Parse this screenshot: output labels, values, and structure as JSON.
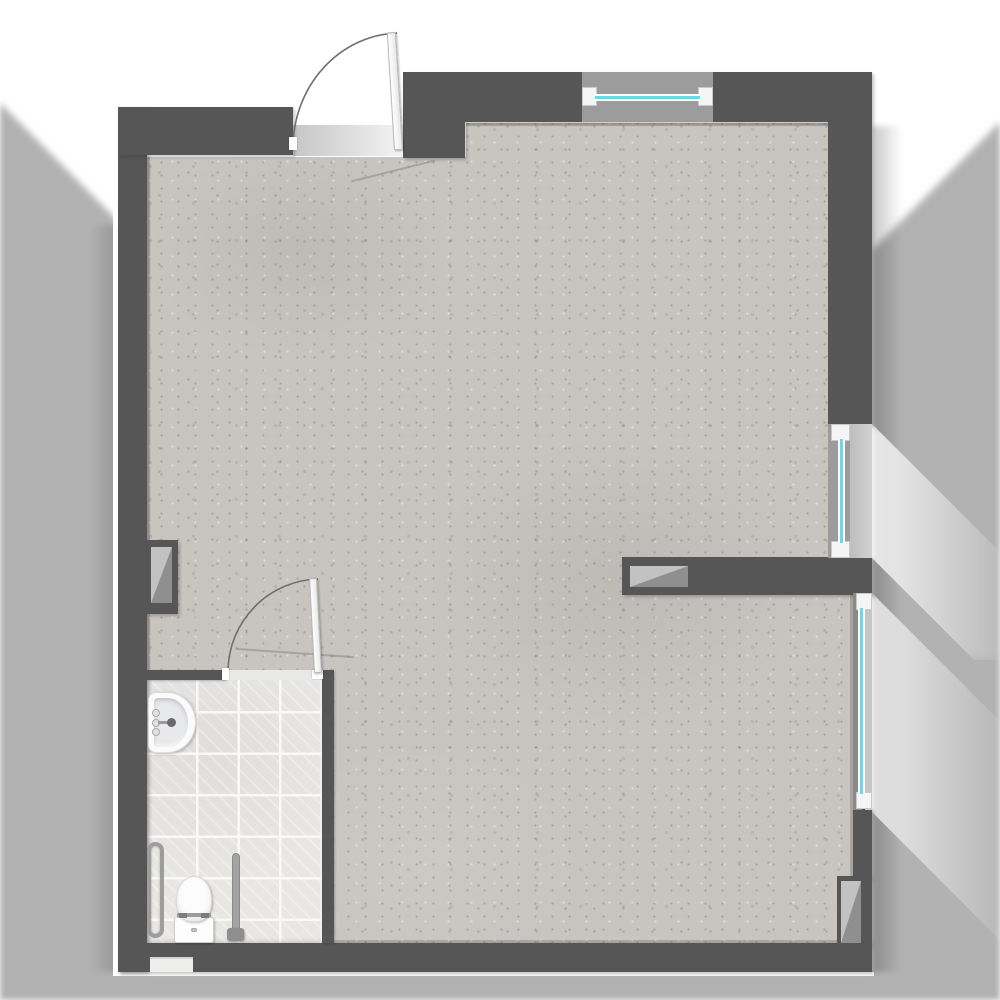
{
  "title": "studio-apartment-floor-plan",
  "colors": {
    "wall": "#565656",
    "floor": "#c8c5c1",
    "tile": "#e8e7e5",
    "grout": "#f9f9f8",
    "window-panel": "#9c9c9c",
    "frame": "#f5f5f5",
    "glass": "#6fd8e6",
    "shaft-light": "#c2c2c2",
    "shaft-dark": "#8f8f8f",
    "fixture": "#fbfbfb",
    "outline": "#ffffff",
    "shadow": "rgba(0,0,0,0.30)"
  },
  "rooms": [
    {
      "name": "main-room",
      "floor_finish": "concrete"
    },
    {
      "name": "bathroom",
      "floor_finish": "ceramic-tile"
    }
  ],
  "doors": [
    {
      "name": "entrance-door",
      "type": "single-swing",
      "swing": "quarter-arc-inward"
    },
    {
      "name": "bathroom-door",
      "type": "single-swing",
      "swing": "quarter-arc-outward"
    }
  ],
  "windows": [
    {
      "name": "top-window",
      "orientation": "horizontal"
    },
    {
      "name": "right-upper-window",
      "orientation": "vertical"
    },
    {
      "name": "right-lower-window",
      "orientation": "vertical"
    }
  ],
  "fixtures": [
    {
      "name": "washbasin"
    },
    {
      "name": "toilet"
    },
    {
      "name": "grab-bar"
    },
    {
      "name": "support-pole"
    },
    {
      "name": "wall-vent"
    }
  ],
  "shafts": [
    {
      "name": "left-wall-shaft"
    },
    {
      "name": "divider-wall-shaft"
    },
    {
      "name": "right-wall-shaft"
    }
  ]
}
